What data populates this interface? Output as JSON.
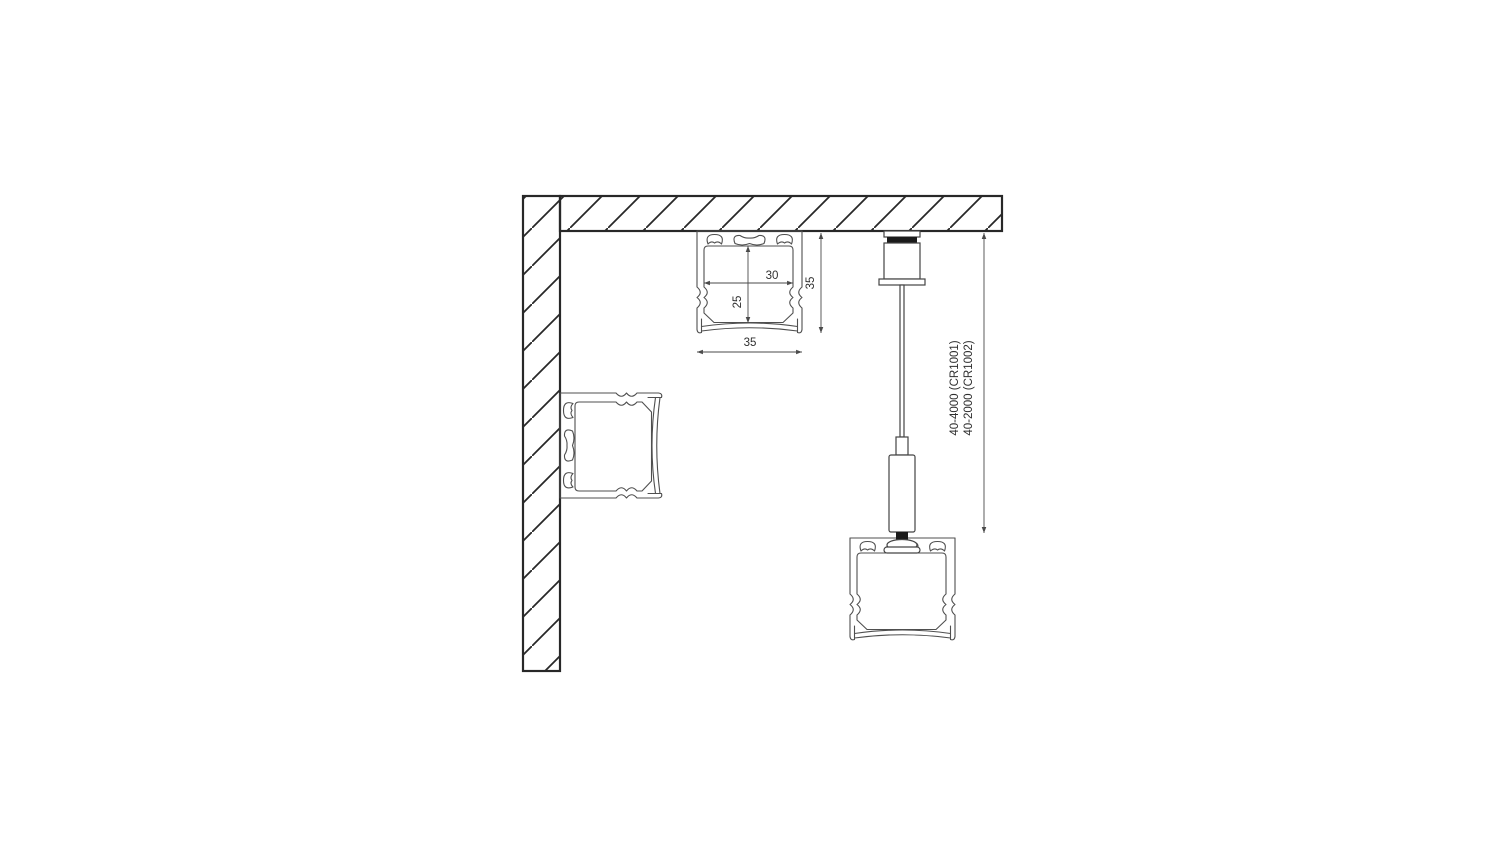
{
  "diagram": {
    "kind": "technical-drawing",
    "colors": {
      "background": "#ffffff",
      "structure_line": "#282828",
      "profile_line": "#4f4f4f",
      "hardware_line": "#444444",
      "dimension_line": "#4a4a4a",
      "solid_black": "#1a1a1a",
      "text": "#2f2f2f"
    },
    "dimension_labels": {
      "inner_width": "30",
      "inner_height": "25",
      "profile_height": "35",
      "profile_width": "35",
      "suspension_length_line1": "40-4000 (CR1001)",
      "suspension_length_line2": "40-2000 (CR1002)"
    }
  }
}
